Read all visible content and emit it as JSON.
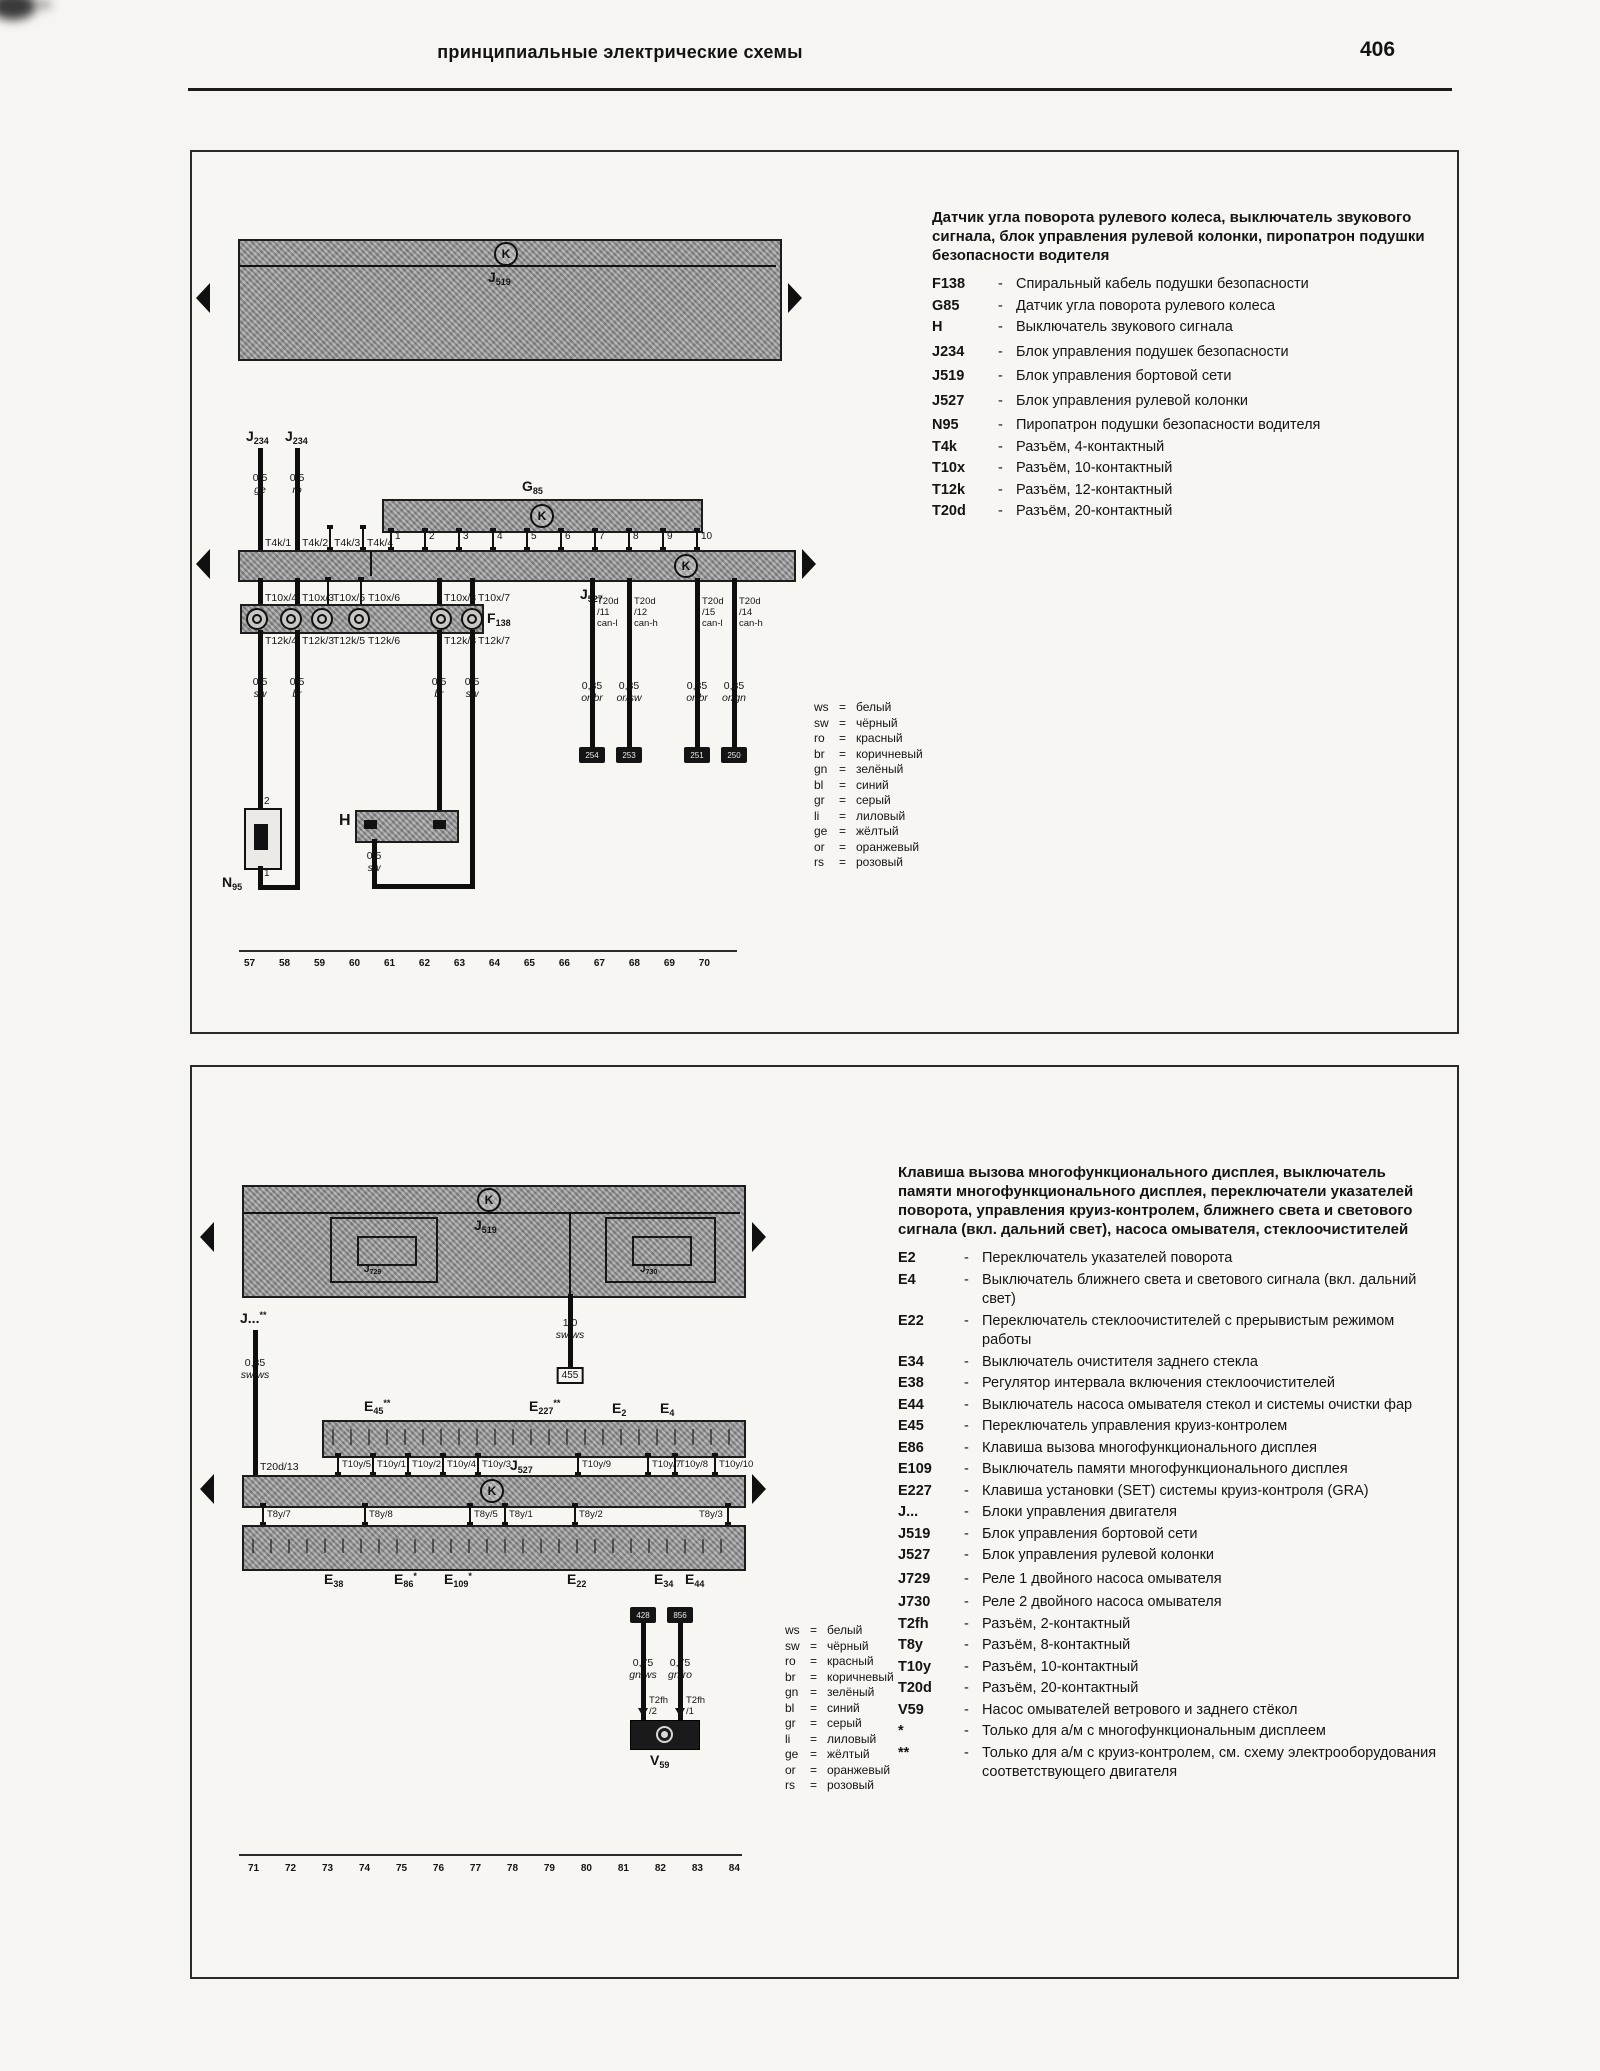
{
  "shared": {
    "dash": "-",
    "eq": "=",
    "k_icon": "K"
  },
  "page": {
    "header_title": "принципиальные электрические схемы",
    "page_number": "406"
  },
  "wire_colors": [
    {
      "abbr": "ws",
      "name": "белый"
    },
    {
      "abbr": "sw",
      "name": "чёрный"
    },
    {
      "abbr": "ro",
      "name": "красный"
    },
    {
      "abbr": "br",
      "name": "коричневый"
    },
    {
      "abbr": "gn",
      "name": "зелёный"
    },
    {
      "abbr": "bl",
      "name": "синий"
    },
    {
      "abbr": "gr",
      "name": "серый"
    },
    {
      "abbr": "li",
      "name": "лиловый"
    },
    {
      "abbr": "ge",
      "name": "жёлтый"
    },
    {
      "abbr": "or",
      "name": "оранжевый"
    },
    {
      "abbr": "rs",
      "name": "розовый"
    }
  ],
  "panel1": {
    "title": "Датчик угла поворота рулевого колеса, выключатель звукового сигнала, блок управления рулевой колонки, пиропатрон подушки безопасности водителя",
    "legend": [
      {
        "code": "F138",
        "desc": "Спиральный кабель подушки безопасности"
      },
      {
        "code": "G85",
        "desc": "Датчик угла поворота рулевого колеса"
      },
      {
        "code": "H",
        "desc": "Выключатель звукового сигнала"
      },
      {
        "code": "J234",
        "desc": "Блок управления подушек безопасности"
      },
      {
        "code": "J519",
        "desc": "Блок управления бортовой сети"
      },
      {
        "code": "J527",
        "desc": "Блок управления рулевой колонки"
      },
      {
        "code": "N95",
        "desc": "Пиропатрон подушки безопасности водителя"
      },
      {
        "code": "T4k",
        "desc": "Разъём, 4-контактный"
      },
      {
        "code": "T10x",
        "desc": "Разъём, 10-контактный"
      },
      {
        "code": "T12k",
        "desc": "Разъём, 12-контактный"
      },
      {
        "code": "T20d",
        "desc": "Разъём, 20-контактный"
      }
    ],
    "diagram": {
      "j519": {
        "b": "J",
        "s": "519"
      },
      "g85": {
        "b": "G",
        "s": "85"
      },
      "j527": {
        "b": "J",
        "s": "527"
      },
      "f138": {
        "b": "F",
        "s": "138"
      },
      "h": {
        "b": "H",
        "s": ""
      },
      "n95": {
        "b": "N",
        "s": "95"
      },
      "j234_left": {
        "b": "J",
        "s": "234"
      },
      "j234_right": {
        "b": "J",
        "s": "234"
      },
      "feed_wires": [
        {
          "size": "0,5",
          "color": "ge"
        },
        {
          "size": "0,5",
          "color": "ro"
        }
      ],
      "t4k": [
        "T4k/1",
        "T4k/2",
        "T4k/3",
        "T4k/4"
      ],
      "g85_pins": [
        "1",
        "2",
        "3",
        "4",
        "5",
        "6",
        "7",
        "8",
        "9",
        "10"
      ],
      "t10x": [
        "T10x/4",
        "T10x/3",
        "T10x/5",
        "T10x/6",
        "T10x/8",
        "T10x/7"
      ],
      "t12k": [
        "T12k/4",
        "T12k/3",
        "T12k/5",
        "T12k/6",
        "T12k/8",
        "T12k/7"
      ],
      "can_wires": [
        {
          "conn": "T20d",
          "pin": "/11",
          "bus": "can-l",
          "size": "0,35",
          "color": "or/br",
          "term": "254"
        },
        {
          "conn": "T20d",
          "pin": "/12",
          "bus": "can-h",
          "size": "0,35",
          "color": "or/sw",
          "term": "253"
        },
        {
          "conn": "T20d",
          "pin": "/15",
          "bus": "can-l",
          "size": "0,35",
          "color": "or/br",
          "term": "251"
        },
        {
          "conn": "T20d",
          "pin": "/14",
          "bus": "can-h",
          "size": "0,35",
          "color": "or/gn",
          "term": "250"
        }
      ],
      "drop_wires": [
        {
          "size": "0,5",
          "color": "sw"
        },
        {
          "size": "0,5",
          "color": "br"
        },
        {
          "size": "0,5",
          "color": "br"
        },
        {
          "size": "0,5",
          "color": "sw"
        }
      ],
      "n95_pin_top": "2",
      "n95_pin_bottom": "1",
      "h_wire": {
        "size": "0,5",
        "color": "sw"
      },
      "bottom_numbers": [
        "57",
        "58",
        "59",
        "60",
        "61",
        "62",
        "63",
        "64",
        "65",
        "66",
        "67",
        "68",
        "69",
        "70"
      ]
    }
  },
  "panel2": {
    "title": "Клавиша вызова многофункционального дисплея, выключатель памяти многофункционального дисплея, переключатели указателей поворота, управления круиз-контролем, ближнего света и светового сигнала (вкл. дальний свет), насоса омывателя, стеклоочистителей",
    "legend": [
      {
        "code": "E2",
        "desc": "Переключатель указателей поворота"
      },
      {
        "code": "E4",
        "desc": "Выключатель ближнего света и светового сигнала (вкл. дальний свет)"
      },
      {
        "code": "E22",
        "desc": "Переключатель стеклоочистителей с прерывистым режимом работы"
      },
      {
        "code": "E34",
        "desc": "Выключатель очистителя заднего стекла"
      },
      {
        "code": "E38",
        "desc": "Регулятор интервала включения стеклоочистителей"
      },
      {
        "code": "E44",
        "desc": "Выключатель насоса омывателя стекол и системы очистки фар"
      },
      {
        "code": "E45",
        "desc": "Переключатель управления круиз-контролем"
      },
      {
        "code": "E86",
        "desc": "Клавиша вызова многофункционального дисплея"
      },
      {
        "code": "E109",
        "desc": "Выключатель памяти многофункционального дисплея"
      },
      {
        "code": "E227",
        "desc": "Клавиша установки (SET) системы круиз-контроля (GRA)"
      },
      {
        "code": "J...",
        "desc": "Блоки управления двигателя"
      },
      {
        "code": "J519",
        "desc": "Блок управления бортовой сети"
      },
      {
        "code": "J527",
        "desc": "Блок управления рулевой колонки"
      },
      {
        "code": "J729",
        "desc": "Реле 1 двойного насоса омывателя"
      },
      {
        "code": "J730",
        "desc": "Реле 2 двойного насоса омывателя"
      },
      {
        "code": "T2fh",
        "desc": "Разъём, 2-контактный"
      },
      {
        "code": "T8y",
        "desc": "Разъём, 8-контактный"
      },
      {
        "code": "T10y",
        "desc": "Разъём, 10-контактный"
      },
      {
        "code": "T20d",
        "desc": "Разъём, 20-контактный"
      },
      {
        "code": "V59",
        "desc": "Насос омывателей ветрового и заднего стёкол"
      },
      {
        "code": "*",
        "desc": "Только для а/м с многофункциональным дисплеем"
      },
      {
        "code": "**",
        "desc": "Только для а/м с круиз-контролем, см. схему электрооборудования соответствующего двигателя"
      }
    ],
    "diagram": {
      "j519": {
        "b": "J",
        "s": "519"
      },
      "j729": {
        "b": "J",
        "s": "729"
      },
      "j730": {
        "b": "J",
        "s": "730"
      },
      "j527": {
        "b": "J",
        "s": "527"
      },
      "v59": {
        "b": "V",
        "s": "59"
      },
      "jdots": {
        "b": "J...",
        "sup": "**"
      },
      "branch_wire": {
        "size": "0,35",
        "color": "sw/ws",
        "conn": "T20d/13"
      },
      "mid_wire": {
        "size": "1,0",
        "color": "sw/ws",
        "ref": "455"
      },
      "switches_top": [
        {
          "b": "E",
          "s": "45",
          "sup": "**"
        },
        {
          "b": "E",
          "s": "227",
          "sup": "**"
        },
        {
          "b": "E",
          "s": "2",
          "sup": ""
        },
        {
          "b": "E",
          "s": "4",
          "sup": ""
        }
      ],
      "t10y": [
        "T10y/5",
        "T10y/1",
        "T10y/2",
        "T10y/4",
        "T10y/3",
        "T10y/9",
        "T10y/7",
        "T10y/8",
        "T10y/10"
      ],
      "t8y": [
        "T8y/7",
        "T8y/8",
        "T8y/5",
        "T8y/1",
        "T8y/2",
        "T8y/3"
      ],
      "switches_bottom": [
        {
          "b": "E",
          "s": "38",
          "sup": ""
        },
        {
          "b": "E",
          "s": "86",
          "sup": "*"
        },
        {
          "b": "E",
          "s": "109",
          "sup": "*"
        },
        {
          "b": "E",
          "s": "22",
          "sup": ""
        },
        {
          "b": "E",
          "s": "34",
          "sup": ""
        },
        {
          "b": "E",
          "s": "44",
          "sup": ""
        }
      ],
      "pump_wires": [
        {
          "term": "428",
          "size": "0,75",
          "color": "gn/ws",
          "conn": "T2fh",
          "pin": "/2"
        },
        {
          "term": "856",
          "size": "0,75",
          "color": "gn/ro",
          "conn": "T2fh",
          "pin": "/1"
        }
      ],
      "bottom_numbers": [
        "71",
        "72",
        "73",
        "74",
        "75",
        "76",
        "77",
        "78",
        "79",
        "80",
        "81",
        "82",
        "83",
        "84"
      ]
    }
  }
}
